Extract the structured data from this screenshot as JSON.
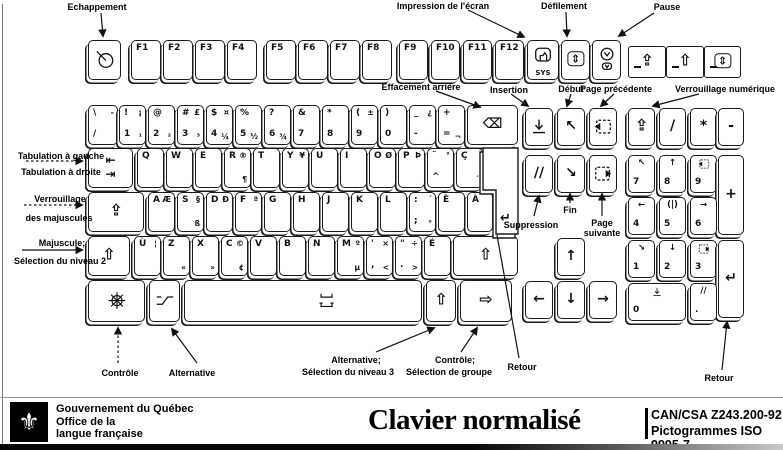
{
  "callouts": {
    "escape": "Echappement",
    "print_screen": "Impression de l'écran",
    "scroll_lock": "Défilement",
    "pause": "Pause",
    "backspace": "Effacement arrière",
    "insert": "Insertion",
    "home": "Début",
    "page_up": "Page précédente",
    "num_lock": "Verrouillage numérique",
    "tab_left": "Tabulation à gauche",
    "tab_right": "Tabulation à droite",
    "caps_line1": "Verrouillage",
    "caps_line2": "des majuscules",
    "shift_line1": "Majuscule;",
    "shift_line2": "Sélection du niveau 2",
    "delete": "Suppression",
    "end": "Fin",
    "page_down_line1": "Page",
    "page_down_line2": "suivante",
    "control": "Contrôle",
    "alt": "Alternative",
    "altgr_line1": "Alternative;",
    "altgr_line2": "Sélection du niveau 3",
    "group_line1": "Contrôle;",
    "group_line2": "Sélection de groupe",
    "return_main": "Retour",
    "return_numpad": "Retour"
  },
  "footer": {
    "gov": "Gouvernement du Québec",
    "office_line1": "Office de la",
    "office_line2": "langue française",
    "logo_glyph": "⚜",
    "logo_icon": "fleur-de-lis",
    "title": "Clavier normalisé",
    "standard_line1": "CAN/CSA Z243.200-92",
    "standard_line2": "Pictogrammes ISO 9995-7"
  },
  "keyboard": {
    "enter": {
      "name": "key-enter",
      "glyph": "↵"
    },
    "keys": [
      {
        "name": "key-escape",
        "x": 88,
        "y": 40,
        "w": 33,
        "h": 40,
        "icon": "esc"
      },
      {
        "name": "key-f1",
        "x": 131,
        "y": 40,
        "w": 30,
        "h": 40,
        "tl": "F1"
      },
      {
        "name": "key-f2",
        "x": 163,
        "y": 40,
        "w": 30,
        "h": 40,
        "tl": "F2"
      },
      {
        "name": "key-f3",
        "x": 195,
        "y": 40,
        "w": 30,
        "h": 40,
        "tl": "F3"
      },
      {
        "name": "key-f4",
        "x": 227,
        "y": 40,
        "w": 30,
        "h": 40,
        "tl": "F4"
      },
      {
        "name": "key-f5",
        "x": 266,
        "y": 40,
        "w": 30,
        "h": 40,
        "tl": "F5"
      },
      {
        "name": "key-f6",
        "x": 298,
        "y": 40,
        "w": 30,
        "h": 40,
        "tl": "F6"
      },
      {
        "name": "key-f7",
        "x": 330,
        "y": 40,
        "w": 30,
        "h": 40,
        "tl": "F7"
      },
      {
        "name": "key-f8",
        "x": 362,
        "y": 40,
        "w": 30,
        "h": 40,
        "tl": "F8"
      },
      {
        "name": "key-f9",
        "x": 399,
        "y": 40,
        "w": 29,
        "h": 40,
        "tl": "F9"
      },
      {
        "name": "key-f10",
        "x": 431,
        "y": 40,
        "w": 29,
        "h": 40,
        "tl": "F10"
      },
      {
        "name": "key-f11",
        "x": 463,
        "y": 40,
        "w": 29,
        "h": 40,
        "tl": "F11"
      },
      {
        "name": "key-f12",
        "x": 495,
        "y": 40,
        "w": 29,
        "h": 40,
        "tl": "F12"
      },
      {
        "name": "key-print-screen",
        "x": 527,
        "y": 40,
        "w": 32,
        "h": 40,
        "icon": "print",
        "bc": "SYS",
        "cls": "icon-top"
      },
      {
        "name": "key-scroll-lock",
        "x": 561,
        "y": 40,
        "w": 29,
        "h": 40,
        "c": "⇕",
        "boxed": true
      },
      {
        "name": "key-pause",
        "x": 592,
        "y": 40,
        "w": 29,
        "h": 40,
        "icon": "pause",
        "cls": "pausekey"
      },
      {
        "name": "indicator-num-lock",
        "x": 628,
        "y": 46,
        "w": 38,
        "h": 32,
        "cls": "flat big",
        "c": "⇪",
        "led": true
      },
      {
        "name": "indicator-caps-lock",
        "x": 666,
        "y": 46,
        "w": 38,
        "h": 32,
        "cls": "flat big",
        "c": "⇧",
        "led": true
      },
      {
        "name": "indicator-scroll-lock",
        "x": 704,
        "y": 46,
        "w": 37,
        "h": 32,
        "cls": "flat",
        "c": "⇕",
        "boxed": true,
        "led": true
      },
      {
        "name": "key-slash",
        "x": 88,
        "y": 105,
        "w": 30,
        "h": 40,
        "tl": "\\",
        "tr": "-",
        "bl": "/"
      },
      {
        "name": "key-1",
        "x": 119,
        "y": 105,
        "w": 27,
        "h": 40,
        "tl": "!",
        "tr": "¡",
        "bl": "1",
        "br": "¹"
      },
      {
        "name": "key-2",
        "x": 148,
        "y": 105,
        "w": 27,
        "h": 40,
        "tl": "@",
        "bl": "2",
        "br": "²"
      },
      {
        "name": "key-3",
        "x": 177,
        "y": 105,
        "w": 27,
        "h": 40,
        "tl": "#",
        "tr": "£",
        "bl": "3",
        "br": "³"
      },
      {
        "name": "key-4",
        "x": 206,
        "y": 105,
        "w": 27,
        "h": 40,
        "tl": "$",
        "tr": "¤",
        "bl": "4",
        "br": "¼"
      },
      {
        "name": "key-5",
        "x": 235,
        "y": 105,
        "w": 27,
        "h": 40,
        "tl": "%",
        "bl": "5",
        "br": "½"
      },
      {
        "name": "key-6",
        "x": 264,
        "y": 105,
        "w": 27,
        "h": 40,
        "tl": "?",
        "bl": "6",
        "br": "¾"
      },
      {
        "name": "key-7",
        "x": 293,
        "y": 105,
        "w": 27,
        "h": 40,
        "tl": "&",
        "bl": "7"
      },
      {
        "name": "key-8",
        "x": 322,
        "y": 105,
        "w": 27,
        "h": 40,
        "tl": "*",
        "bl": "8"
      },
      {
        "name": "key-9",
        "x": 351,
        "y": 105,
        "w": 27,
        "h": 40,
        "tl": "(",
        "tr": "±",
        "bl": "9"
      },
      {
        "name": "key-0",
        "x": 380,
        "y": 105,
        "w": 27,
        "h": 40,
        "tl": ")",
        "bl": "0"
      },
      {
        "name": "key-minus",
        "x": 409,
        "y": 105,
        "w": 27,
        "h": 40,
        "tl": "_",
        "tr": "¿",
        "bl": "-"
      },
      {
        "name": "key-equals",
        "x": 438,
        "y": 105,
        "w": 27,
        "h": 40,
        "tl": "+",
        "bl": "=",
        "br": "¬"
      },
      {
        "name": "key-backspace",
        "x": 467,
        "y": 105,
        "w": 51,
        "h": 40,
        "c": "⌫"
      },
      {
        "name": "key-tab",
        "x": 88,
        "y": 148,
        "w": 45,
        "h": 40,
        "cls": "tabkey",
        "tc": "⇤",
        "bc": "⇥"
      },
      {
        "name": "key-q",
        "x": 137,
        "y": 148,
        "w": 27,
        "h": 40,
        "tl": "Q"
      },
      {
        "name": "key-w",
        "x": 166,
        "y": 148,
        "w": 27,
        "h": 40,
        "tl": "W"
      },
      {
        "name": "key-e",
        "x": 195,
        "y": 148,
        "w": 27,
        "h": 40,
        "tl": "E"
      },
      {
        "name": "key-r",
        "x": 224,
        "y": 148,
        "w": 27,
        "h": 40,
        "tl": "R",
        "tr": "®",
        "br": "¶"
      },
      {
        "name": "key-t",
        "x": 253,
        "y": 148,
        "w": 27,
        "h": 40,
        "tl": "T"
      },
      {
        "name": "key-y",
        "x": 282,
        "y": 148,
        "w": 27,
        "h": 40,
        "tl": "Y",
        "tr": "¥"
      },
      {
        "name": "key-u",
        "x": 311,
        "y": 148,
        "w": 27,
        "h": 40,
        "tl": "U"
      },
      {
        "name": "key-i",
        "x": 340,
        "y": 148,
        "w": 27,
        "h": 40,
        "tl": "I"
      },
      {
        "name": "key-o",
        "x": 369,
        "y": 148,
        "w": 27,
        "h": 40,
        "tl": "O",
        "tr": "Ø"
      },
      {
        "name": "key-p",
        "x": 398,
        "y": 148,
        "w": 27,
        "h": 40,
        "tl": "P",
        "tr": "Þ"
      },
      {
        "name": "key-circumflex",
        "x": 427,
        "y": 148,
        "w": 27,
        "h": 40,
        "tl": "¨",
        "tr": "°",
        "bl": "^"
      },
      {
        "name": "key-c-cedilla",
        "x": 456,
        "y": 148,
        "w": 27,
        "h": 40,
        "tl": "Ç",
        "br": "´"
      },
      {
        "name": "key-caps-lock",
        "x": 88,
        "y": 192,
        "w": 56,
        "h": 40,
        "cls": "big",
        "c": "⇪"
      },
      {
        "name": "key-a",
        "x": 148,
        "y": 192,
        "w": 27,
        "h": 40,
        "tl": "A",
        "tr": "Æ"
      },
      {
        "name": "key-s",
        "x": 177,
        "y": 192,
        "w": 27,
        "h": 40,
        "tl": "S",
        "tr": "§",
        "br": "ß"
      },
      {
        "name": "key-d",
        "x": 206,
        "y": 192,
        "w": 27,
        "h": 40,
        "tl": "D",
        "tr": "Ð"
      },
      {
        "name": "key-f",
        "x": 235,
        "y": 192,
        "w": 27,
        "h": 40,
        "tl": "F",
        "tr": "ª"
      },
      {
        "name": "key-g",
        "x": 264,
        "y": 192,
        "w": 27,
        "h": 40,
        "tl": "G"
      },
      {
        "name": "key-h",
        "x": 293,
        "y": 192,
        "w": 27,
        "h": 40,
        "tl": "H"
      },
      {
        "name": "key-j",
        "x": 322,
        "y": 192,
        "w": 27,
        "h": 40,
        "tl": "J"
      },
      {
        "name": "key-k",
        "x": 351,
        "y": 192,
        "w": 27,
        "h": 40,
        "tl": "K"
      },
      {
        "name": "key-l",
        "x": 380,
        "y": 192,
        "w": 27,
        "h": 40,
        "tl": "L"
      },
      {
        "name": "key-semicolon",
        "x": 409,
        "y": 192,
        "w": 27,
        "h": 40,
        "tl": ":",
        "tr": "´",
        "bl": ";",
        "br": "°"
      },
      {
        "name": "key-e-grave",
        "x": 438,
        "y": 192,
        "w": 27,
        "h": 40,
        "tl": "È"
      },
      {
        "name": "key-a-grave",
        "x": 467,
        "y": 192,
        "w": 26,
        "h": 40,
        "tl": "À"
      },
      {
        "name": "key-left-shift",
        "x": 88,
        "y": 236,
        "w": 42,
        "h": 40,
        "cls": "big",
        "c": "⇧"
      },
      {
        "name": "key-u-grave",
        "x": 134,
        "y": 236,
        "w": 27,
        "h": 40,
        "tl": "Ù",
        "tr": "¦"
      },
      {
        "name": "key-z",
        "x": 163,
        "y": 236,
        "w": 27,
        "h": 40,
        "tl": "Z",
        "br": "«"
      },
      {
        "name": "key-x",
        "x": 192,
        "y": 236,
        "w": 27,
        "h": 40,
        "tl": "X",
        "br": "»"
      },
      {
        "name": "key-c",
        "x": 221,
        "y": 236,
        "w": 27,
        "h": 40,
        "tl": "C",
        "tr": "©",
        "br": "¢"
      },
      {
        "name": "key-v",
        "x": 250,
        "y": 236,
        "w": 27,
        "h": 40,
        "tl": "V"
      },
      {
        "name": "key-b",
        "x": 279,
        "y": 236,
        "w": 27,
        "h": 40,
        "tl": "B"
      },
      {
        "name": "key-n",
        "x": 308,
        "y": 236,
        "w": 27,
        "h": 40,
        "tl": "N"
      },
      {
        "name": "key-m",
        "x": 337,
        "y": 236,
        "w": 27,
        "h": 40,
        "tl": "M",
        "tr": "º",
        "br": "µ"
      },
      {
        "name": "key-comma",
        "x": 366,
        "y": 236,
        "w": 27,
        "h": 40,
        "tl": "'",
        "tr": "×",
        "bl": ",",
        "br": "<"
      },
      {
        "name": "key-period",
        "x": 395,
        "y": 236,
        "w": 27,
        "h": 40,
        "tl": "\"",
        "tr": "÷",
        "bl": ".",
        "br": ">"
      },
      {
        "name": "key-e-acute",
        "x": 424,
        "y": 236,
        "w": 27,
        "h": 40,
        "tl": "É"
      },
      {
        "name": "key-right-shift",
        "x": 453,
        "y": 236,
        "w": 65,
        "h": 40,
        "cls": "big",
        "c": "⇧"
      },
      {
        "name": "key-control",
        "x": 88,
        "y": 280,
        "w": 57,
        "h": 42,
        "icon": "ctrl"
      },
      {
        "name": "key-alt",
        "x": 149,
        "y": 280,
        "w": 31,
        "h": 42,
        "icon": "alt"
      },
      {
        "name": "key-space",
        "x": 184,
        "y": 280,
        "w": 238,
        "h": 42,
        "cls": "spacekey",
        "icon": "space"
      },
      {
        "name": "key-alt-gr",
        "x": 426,
        "y": 280,
        "w": 30,
        "h": 42,
        "cls": "big",
        "c": "⇧"
      },
      {
        "name": "key-group-select",
        "x": 460,
        "y": 280,
        "w": 52,
        "h": 42,
        "cls": "big",
        "c": "⇨"
      },
      {
        "name": "key-insert",
        "x": 525,
        "y": 108,
        "w": 28,
        "h": 38,
        "icon": "insert"
      },
      {
        "name": "key-home",
        "x": 557,
        "y": 108,
        "w": 28,
        "h": 38,
        "c": "↖"
      },
      {
        "name": "key-page-up",
        "x": 589,
        "y": 108,
        "w": 28,
        "h": 38,
        "icon": "pgup"
      },
      {
        "name": "key-delete",
        "x": 525,
        "y": 155,
        "w": 28,
        "h": 38,
        "c": "∕∕"
      },
      {
        "name": "key-end",
        "x": 557,
        "y": 155,
        "w": 28,
        "h": 38,
        "c": "↘"
      },
      {
        "name": "key-page-down",
        "x": 589,
        "y": 155,
        "w": 28,
        "h": 38,
        "icon": "pgdn"
      },
      {
        "name": "key-arrow-up",
        "x": 557,
        "y": 238,
        "w": 28,
        "h": 38,
        "c": "↑"
      },
      {
        "name": "key-arrow-left",
        "x": 525,
        "y": 281,
        "w": 28,
        "h": 38,
        "c": "←"
      },
      {
        "name": "key-arrow-down",
        "x": 557,
        "y": 281,
        "w": 28,
        "h": 38,
        "c": "↓"
      },
      {
        "name": "key-arrow-right",
        "x": 589,
        "y": 281,
        "w": 28,
        "h": 38,
        "c": "→"
      },
      {
        "name": "key-num-lock",
        "x": 628,
        "y": 108,
        "w": 27,
        "h": 38,
        "cls": "big",
        "c": "⇪"
      },
      {
        "name": "key-numpad-divide",
        "x": 659,
        "y": 108,
        "w": 27,
        "h": 38,
        "c": "/"
      },
      {
        "name": "key-numpad-multiply",
        "x": 690,
        "y": 108,
        "w": 27,
        "h": 38,
        "c": "*"
      },
      {
        "name": "key-numpad-subtract",
        "x": 718,
        "y": 108,
        "w": 26,
        "h": 38,
        "c": "-"
      },
      {
        "name": "key-numpad-7",
        "x": 628,
        "y": 155,
        "w": 27,
        "h": 38,
        "cls": "np",
        "tc": "↖",
        "bl": "7"
      },
      {
        "name": "key-numpad-8",
        "x": 659,
        "y": 155,
        "w": 27,
        "h": 38,
        "cls": "np",
        "tc": "↑",
        "bl": "8"
      },
      {
        "name": "key-numpad-9",
        "x": 690,
        "y": 155,
        "w": 27,
        "h": 38,
        "cls": "np",
        "icon": "pgup",
        "bl": "9"
      },
      {
        "name": "key-numpad-add",
        "x": 718,
        "y": 155,
        "w": 26,
        "h": 80,
        "c": "+"
      },
      {
        "name": "key-numpad-4",
        "x": 628,
        "y": 197,
        "w": 27,
        "h": 38,
        "cls": "np",
        "tc": "←",
        "bl": "4"
      },
      {
        "name": "key-numpad-5",
        "x": 659,
        "y": 197,
        "w": 27,
        "h": 38,
        "cls": "np",
        "tc": "(|)",
        "bl": "5"
      },
      {
        "name": "key-numpad-6",
        "x": 690,
        "y": 197,
        "w": 27,
        "h": 38,
        "cls": "np",
        "tc": "→",
        "bl": "6"
      },
      {
        "name": "key-numpad-1",
        "x": 628,
        "y": 240,
        "w": 27,
        "h": 38,
        "cls": "np",
        "tc": "↘",
        "bl": "1"
      },
      {
        "name": "key-numpad-2",
        "x": 659,
        "y": 240,
        "w": 27,
        "h": 38,
        "cls": "np",
        "tc": "↓",
        "bl": "2"
      },
      {
        "name": "key-numpad-3",
        "x": 690,
        "y": 240,
        "w": 27,
        "h": 38,
        "cls": "np",
        "icon": "pgdn",
        "bl": "3"
      },
      {
        "name": "key-numpad-enter",
        "x": 718,
        "y": 240,
        "w": 26,
        "h": 78,
        "c": "↵"
      },
      {
        "name": "key-numpad-0",
        "x": 628,
        "y": 283,
        "w": 58,
        "h": 38,
        "cls": "np",
        "icon": "insert",
        "bl": "0"
      },
      {
        "name": "key-numpad-decimal",
        "x": 690,
        "y": 283,
        "w": 27,
        "h": 38,
        "cls": "np",
        "tc": "∕∕",
        "bl": "."
      }
    ]
  }
}
